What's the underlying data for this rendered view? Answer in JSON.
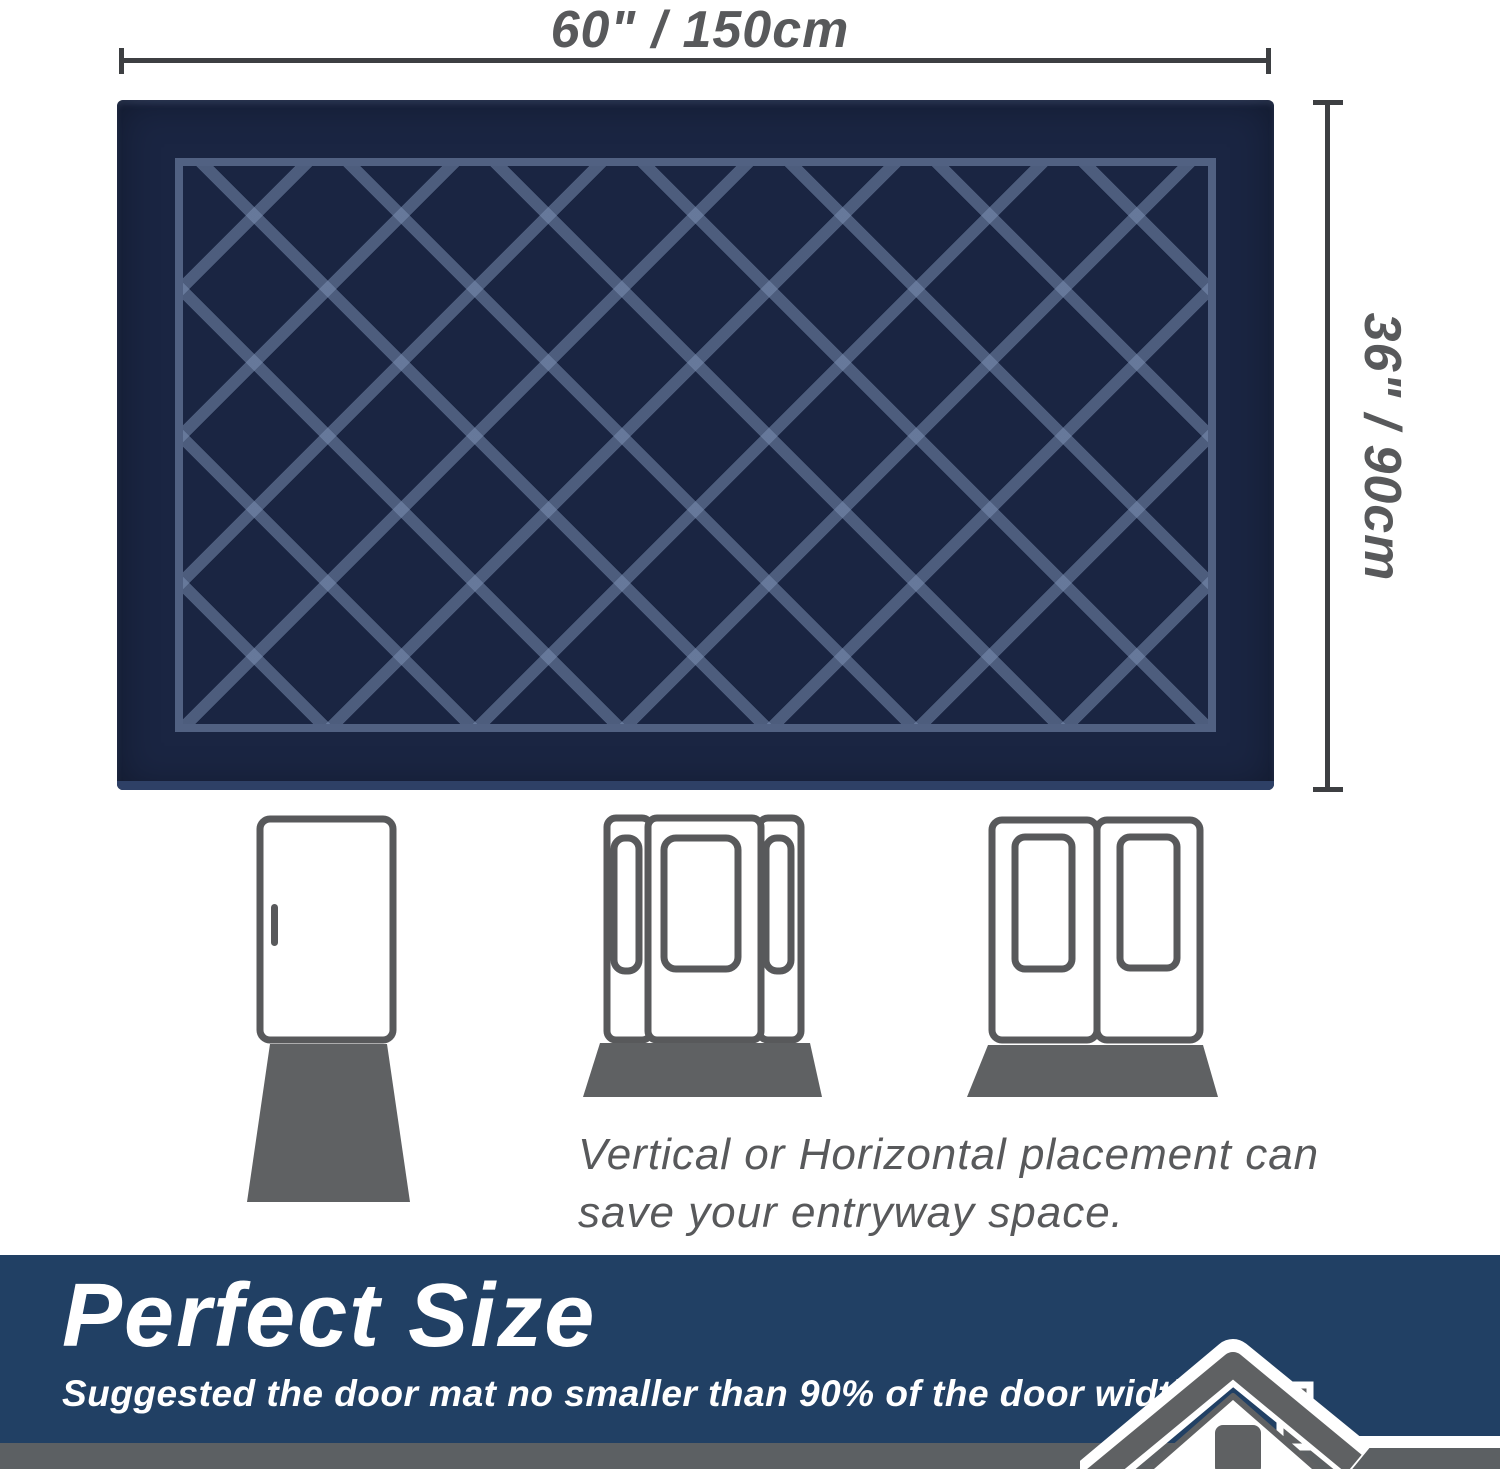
{
  "dimensions": {
    "width_label": "60\" / 150cm",
    "height_label": "36\" / 90cm",
    "line_color": "#3d3f42",
    "label_color": "#58595b"
  },
  "mat": {
    "pattern": "diamond-lattice",
    "color": "#1a2542",
    "pattern_color": "#8094b8",
    "edge_color": "#2e4066"
  },
  "placement": {
    "caption_line1": "Vertical or Horizontal placement can",
    "caption_line2": "save your entryway space.",
    "doors": [
      "single-door",
      "door-with-sidelights",
      "double-door"
    ],
    "door_outline_color": "#58595b",
    "floor_mat_color": "#5f6163"
  },
  "banner": {
    "title": "Perfect Size",
    "subtitle": "Suggested the door mat no smaller than 90% of the door width.",
    "background": "#214064",
    "strip_color": "#5c6063",
    "text_color": "#ffffff"
  }
}
